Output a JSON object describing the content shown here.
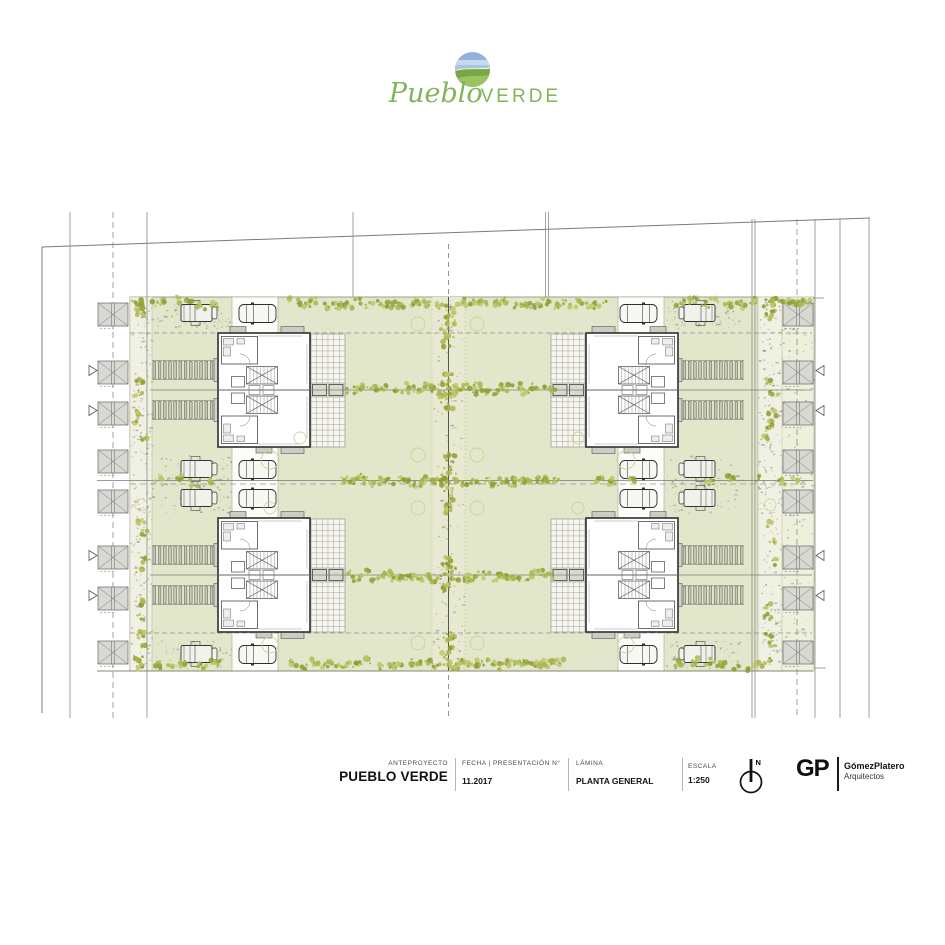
{
  "logo": {
    "brand_script": "Pueblo",
    "brand_caps": "VERDE"
  },
  "title_block": {
    "project_label": "ANTEPROYECTO",
    "project_name": "PUEBLO VERDE",
    "date_label": "FECHA | PRESENTACIÓN N°",
    "date_value": "11.2017",
    "sheet_label": "LÁMINA",
    "sheet_value": "PLANTA GENERAL",
    "scale_label": "ESCALA",
    "scale_value": "1:250",
    "north_label": "N",
    "firm_initials": "GP",
    "firm_name": "GómezPlatero",
    "firm_subtitle": "Arquitectos"
  },
  "plan": {
    "sheet_type": "site plan",
    "building_units": 4,
    "garage_bays_left": 8,
    "garage_bays_right": 8,
    "parked_cars": 16
  },
  "palette": {
    "site_green": "#e2e6ca",
    "pale_green": "#edf0da",
    "path_light": "#f0f1e2",
    "patio": "#f6f6ef",
    "tree_olive": "#a9b54e",
    "tree_dark": "#8f9c33",
    "tree_light": "#bcc569",
    "canopy_outline": "#ced293",
    "line_gray": "#8b8b8b",
    "wall_dark": "#3a3a3a",
    "drive_white": "#fcfcf8",
    "garage_fill": "#d9d9d3",
    "rib_fill": "#c6cab3",
    "logo_sky": "#8fb2da",
    "logo_sky_light": "#c9daee",
    "logo_hill_dark": "#79a746",
    "logo_hill_light": "#9cc263",
    "logo_text": "#82b55a",
    "footer_dark": "#161616"
  }
}
